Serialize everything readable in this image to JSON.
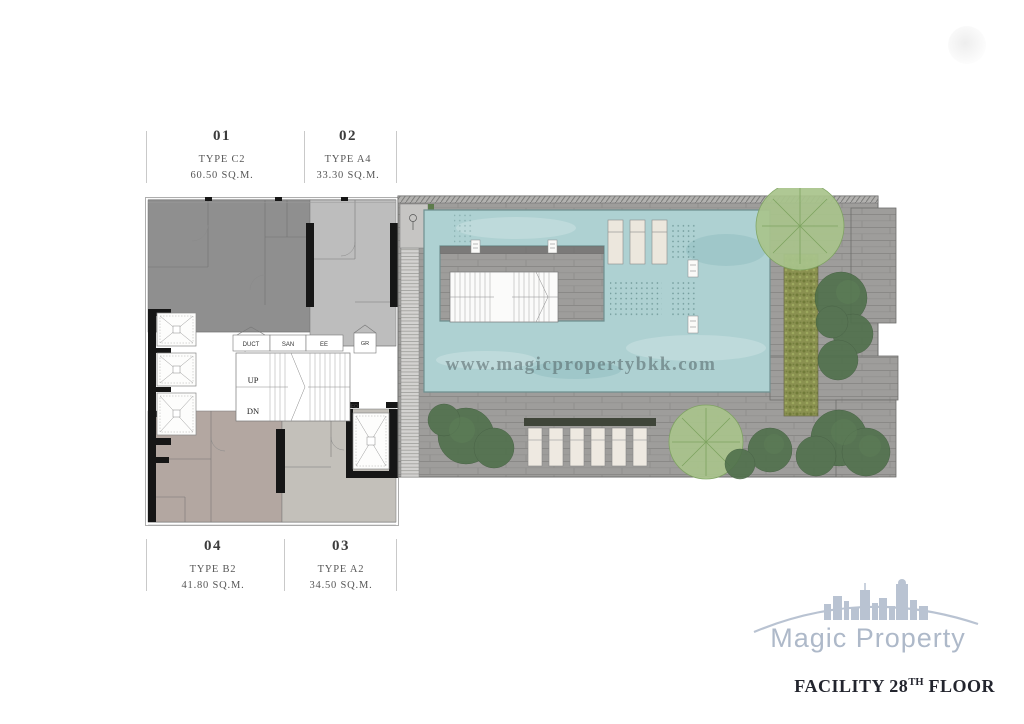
{
  "canvas": {
    "width": 1024,
    "height": 724,
    "background": "#ffffff"
  },
  "top_units": [
    {
      "number": "01",
      "type": "TYPE C2",
      "area": "60.50 SQ.M."
    },
    {
      "number": "02",
      "type": "TYPE A4",
      "area": "33.30 SQ.M."
    }
  ],
  "bottom_units": [
    {
      "number": "04",
      "type": "TYPE B2",
      "area": "41.80 SQ.M."
    },
    {
      "number": "03",
      "type": "TYPE A2",
      "area": "34.50 SQ.M."
    }
  ],
  "core": {
    "duct": "DUCT",
    "san": "SAN",
    "ee": "EE",
    "up": "UP",
    "dn": "DN",
    "gr": "GR",
    "fo": "FO"
  },
  "watermark": {
    "url_text": "www.magicpropertybkk.com"
  },
  "branding": {
    "logo": "Magic Property",
    "caption_main": "FACILITY 28",
    "caption_sup": "TH",
    "caption_tail": " FLOOR"
  },
  "colors": {
    "unit_c2": "#8f8f8f",
    "unit_a4": "#bdbdbd",
    "unit_b2": "#b3a7a1",
    "unit_a2": "#c3c0ba",
    "pool_water": "#aed1d2",
    "deck_gray": "#9e9d9b",
    "planter_olive": "#8a9150",
    "tree_dark": "#4e6f4a",
    "tree_light": "#a9c48c",
    "wall_black": "#161616",
    "logo_blue": "#b3bfcf",
    "caption_ink": "#23252e"
  }
}
